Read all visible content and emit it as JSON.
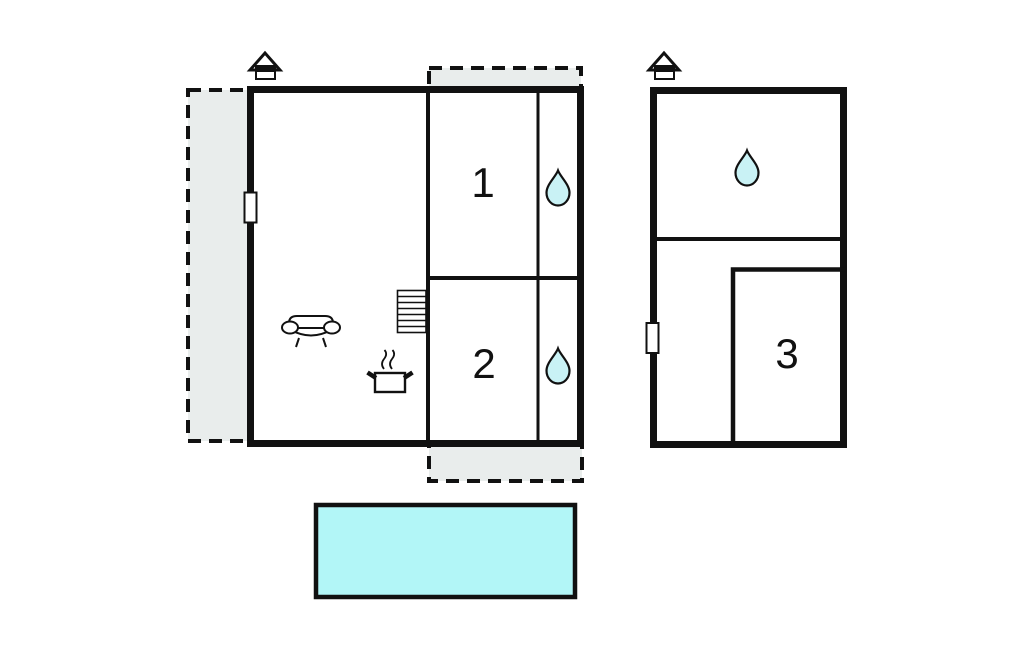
{
  "floor_plan": {
    "title": "holiday-home-floor-plan",
    "rooms": [
      {
        "id": "room-1",
        "label": "1"
      },
      {
        "id": "room-2",
        "label": "2"
      },
      {
        "id": "room-3",
        "label": "3"
      }
    ],
    "colors": {
      "wall": "#111111",
      "terrace_fill": "#e9edec",
      "pool_fill": "#b2f6f7",
      "drop_fill": "#c9f2f5",
      "white": "#ffffff"
    },
    "icons": {
      "house_entrance": "house-entrance-marker",
      "water_drop": "water-supply-point",
      "sofa": "sofa-living-area",
      "cooking_pot": "kitchen-stove-pot",
      "stairs": "staircase"
    }
  }
}
